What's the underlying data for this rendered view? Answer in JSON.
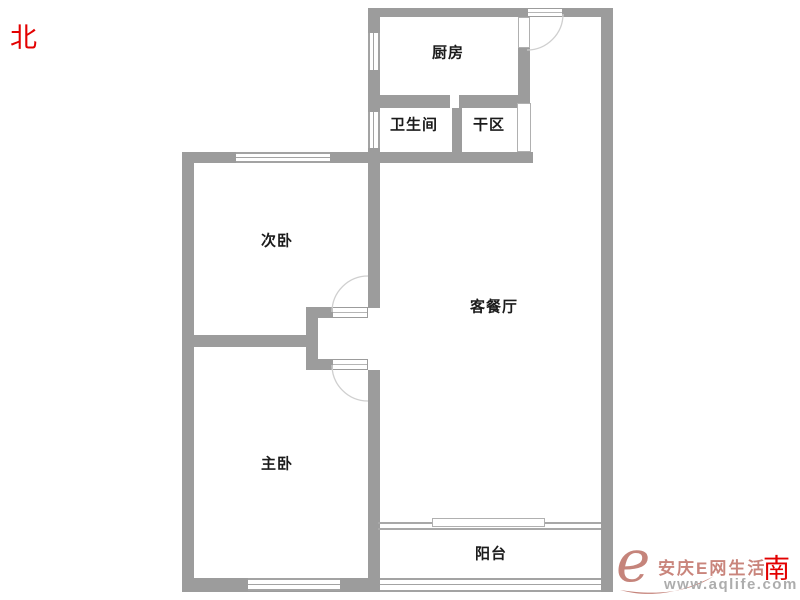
{
  "compass": {
    "north": "北",
    "south": "南"
  },
  "rooms": [
    {
      "id": "kitchen",
      "label": "厨房"
    },
    {
      "id": "bathroom",
      "label": "卫生间"
    },
    {
      "id": "dry-area",
      "label": "干区"
    },
    {
      "id": "second-bedroom",
      "label": "次卧"
    },
    {
      "id": "living-dining",
      "label": "客餐厅"
    },
    {
      "id": "master-bedroom",
      "label": "主卧"
    },
    {
      "id": "balcony",
      "label": "阳台"
    }
  ],
  "watermark": {
    "logo": "e",
    "brand": "安庆E网生活",
    "url": "www.aqlife.com"
  },
  "colors": {
    "wall_gray": "#9c9c9c",
    "window_line_gray": "#a3a3a3",
    "door_arc_gray": "#cfcfcf",
    "label_black": "#1b1b1b",
    "compass_red": "#e30000",
    "watermark_pink": "#c9857c",
    "watermark_gray": "#adadad"
  }
}
